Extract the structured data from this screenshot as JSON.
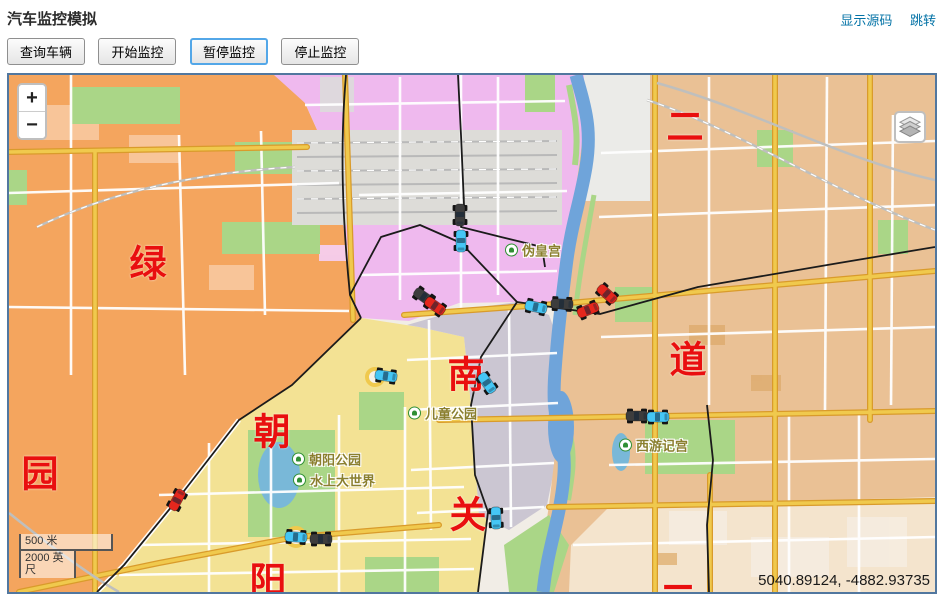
{
  "header": {
    "title": "汽车监控模拟",
    "links": [
      {
        "label": "显示源码"
      },
      {
        "label": "跳转"
      }
    ]
  },
  "toolbar": {
    "buttons": [
      {
        "label": "查询车辆",
        "focused": false
      },
      {
        "label": "开始监控",
        "focused": false
      },
      {
        "label": "暂停监控",
        "focused": true
      },
      {
        "label": "停止监控",
        "focused": false
      }
    ]
  },
  "map": {
    "zoom_in": "+",
    "zoom_out": "−",
    "scale_metric": "500 米",
    "scale_imperial": "2000 英尺",
    "coordinates": "5040.89124, -4882.93735",
    "district_labels": [
      {
        "text": "二",
        "x": 676,
        "y": 52
      },
      {
        "text": "绿",
        "x": 139,
        "y": 189
      },
      {
        "text": "道",
        "x": 679,
        "y": 285
      },
      {
        "text": "南",
        "x": 457,
        "y": 300
      },
      {
        "text": "朝",
        "x": 263,
        "y": 357
      },
      {
        "text": "园",
        "x": 31,
        "y": 399
      },
      {
        "text": "关",
        "x": 459,
        "y": 440
      },
      {
        "text": "阳",
        "x": 259,
        "y": 506
      },
      {
        "text": "二",
        "x": 669,
        "y": 524
      }
    ],
    "poi_labels": [
      {
        "text": "伪皇宫",
        "x": 496,
        "y": 175
      },
      {
        "text": "儿童公园",
        "x": 399,
        "y": 338
      },
      {
        "text": "朝阳公园",
        "x": 283,
        "y": 384
      },
      {
        "text": "水上大世界",
        "x": 284,
        "y": 405
      },
      {
        "text": "西游记宫",
        "x": 610,
        "y": 370
      }
    ],
    "cars": [
      {
        "x": 451,
        "y": 140,
        "angle": 90,
        "color": "dark"
      },
      {
        "x": 452,
        "y": 166,
        "angle": 90,
        "color": "cyan"
      },
      {
        "x": 415,
        "y": 222,
        "angle": 35,
        "color": "dark"
      },
      {
        "x": 426,
        "y": 231,
        "angle": 35,
        "color": "red"
      },
      {
        "x": 527,
        "y": 232,
        "angle": 12,
        "color": "cyan"
      },
      {
        "x": 553,
        "y": 229,
        "angle": 3,
        "color": "dark"
      },
      {
        "x": 579,
        "y": 235,
        "angle": -22,
        "color": "red"
      },
      {
        "x": 598,
        "y": 219,
        "angle": 42,
        "color": "red"
      },
      {
        "x": 377,
        "y": 301,
        "angle": 8,
        "color": "cyan"
      },
      {
        "x": 478,
        "y": 308,
        "angle": 55,
        "color": "cyan"
      },
      {
        "x": 628,
        "y": 341,
        "angle": 0,
        "color": "dark"
      },
      {
        "x": 649,
        "y": 342,
        "angle": 0,
        "color": "cyan"
      },
      {
        "x": 168,
        "y": 425,
        "angle": -62,
        "color": "red"
      },
      {
        "x": 287,
        "y": 462,
        "angle": 4,
        "color": "cyan"
      },
      {
        "x": 312,
        "y": 464,
        "angle": 0,
        "color": "dark"
      },
      {
        "x": 487,
        "y": 443,
        "angle": 88,
        "color": "cyan"
      }
    ],
    "car_colors": {
      "cyan": "#45c6f5",
      "red": "#e5271d",
      "dark": "#3d3d3d"
    }
  },
  "palette": {
    "base": "#f1ede6",
    "orange": "#f4a55e",
    "pink": "#efb9ee",
    "gray": "#cbc6d2",
    "yellow": "#f3e294",
    "tan": "#eac195",
    "tan-light": "#f4e4cd",
    "park": "#aad687",
    "water": "#6fa4da",
    "road-yellow": "#f0c94d",
    "road-casing": "#d99b2b",
    "rail": "#bfbfbd",
    "rail-yard": "#dddcd8",
    "boundary": "#1b1b1b",
    "border": "#51779f",
    "link": "#0272a6",
    "red-label": "#e90f0f",
    "poi": "#8a7f2e"
  }
}
